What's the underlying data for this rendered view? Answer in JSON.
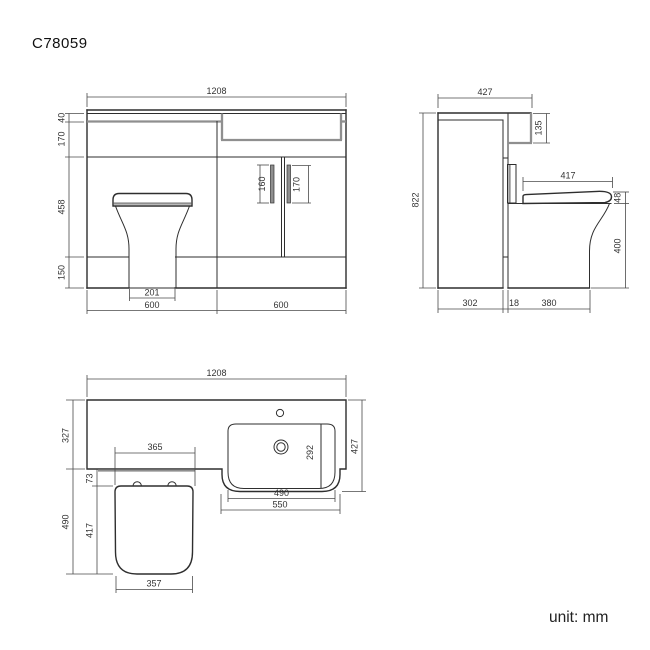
{
  "title": "C78059",
  "unit_label": "unit: mm",
  "views": {
    "front": {
      "name": "front elevation",
      "dims": {
        "overall_width": "1208",
        "counter_thickness": "40",
        "upper_section_height": "170",
        "mid_section_height": "458",
        "plinth_height": "150",
        "left_door_handle": "160",
        "right_door_handle": "170",
        "toilet_base_width": "201",
        "left_module_width": "600",
        "right_module_width": "600"
      }
    },
    "side": {
      "name": "side elevation",
      "dims": {
        "overall_depth": "427",
        "overall_height": "822",
        "basin_ledge_height": "135",
        "seat_length": "417",
        "seat_thickness": "48",
        "pan_height": "400",
        "cabinet_depth": "302",
        "gap": "18",
        "pan_projection": "380"
      }
    },
    "plan": {
      "name": "plan view",
      "dims": {
        "overall_width": "1208",
        "counter_depth": "327",
        "pan_projection": "490",
        "seat_width": "365",
        "seat_setback": "73",
        "seat_depth": "417",
        "seat_front_width": "357",
        "overall_depth": "427",
        "basin_bowl_depth": "292",
        "basin_bowl_width": "490",
        "basin_outer_width": "550"
      }
    }
  },
  "colors": {
    "line": "#2e2e2e",
    "dim_line": "#4a4a4a",
    "accent_gray": "#8f8f8f",
    "background": "#ffffff",
    "text": "#333333"
  }
}
